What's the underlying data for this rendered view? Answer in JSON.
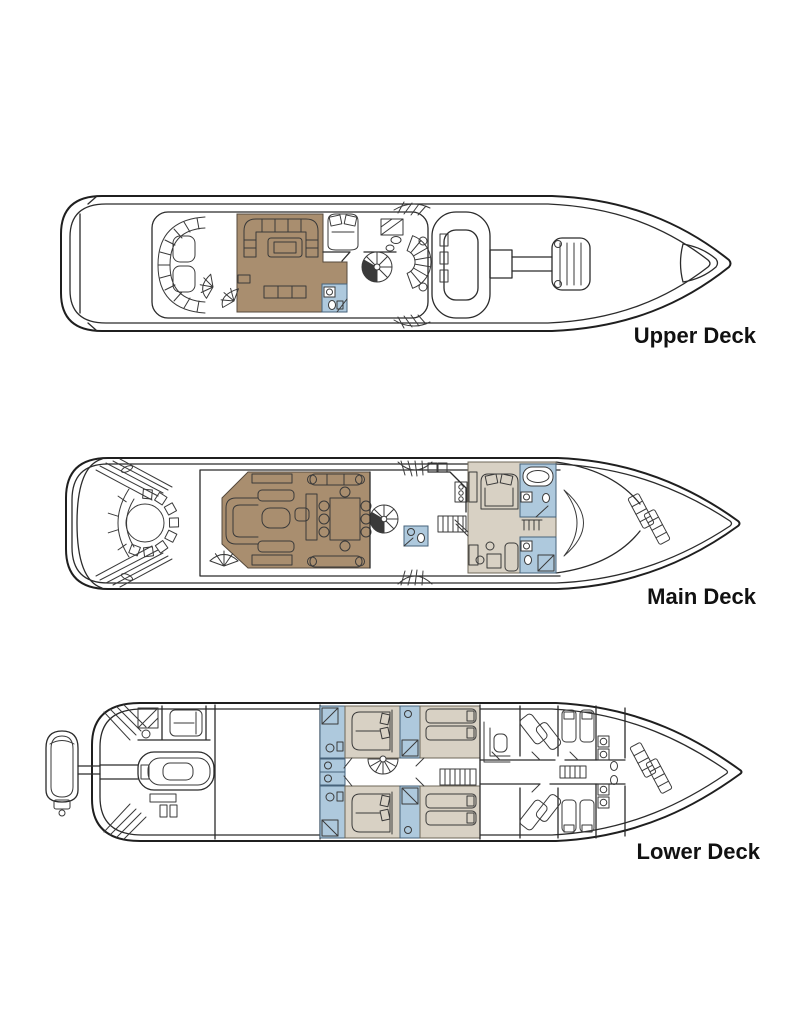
{
  "canvas": {
    "width": 800,
    "height": 1036,
    "background": "#ffffff"
  },
  "colors": {
    "lounge_tan": "#a98e6f",
    "bathroom_blue": "#aec9dd",
    "cabin_beige": "#d8d1c4",
    "line_dark": "#222222",
    "label_text": "#111111"
  },
  "decks": [
    {
      "id": "upper-deck",
      "label": "Upper Deck"
    },
    {
      "id": "main-deck",
      "label": "Main Deck"
    },
    {
      "id": "lower-deck",
      "label": "Lower Deck"
    }
  ]
}
